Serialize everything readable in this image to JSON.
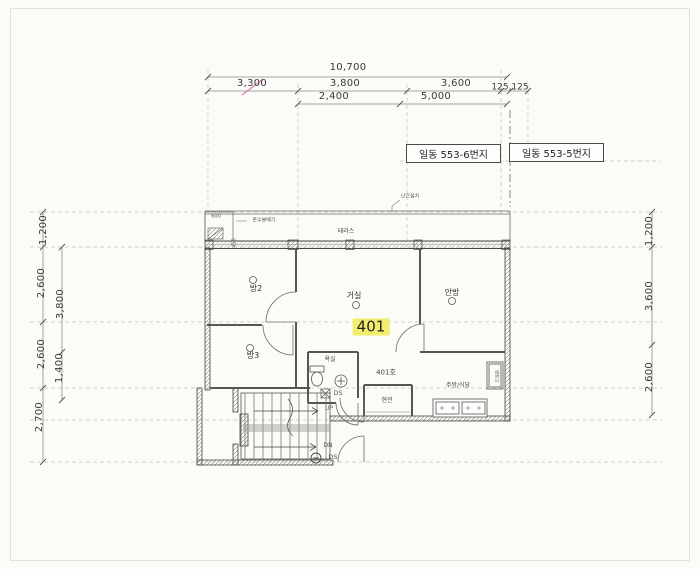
{
  "colors": {
    "highlight": "#f1ee6d",
    "paper": "#fbfbf8"
  },
  "addresses": {
    "left": "일동 553-6번지",
    "right": "일동 553-5번지"
  },
  "dims": {
    "overall": "10,700",
    "t1": "3,300",
    "t2": "3,800",
    "t3": "3,600",
    "t4": "125,125",
    "t5": "2,400",
    "t6": "5,000",
    "l1": "1,200",
    "l2": "2,600",
    "l3": "2,600",
    "l4": "2,700",
    "li1": "3,800",
    "li2": "1,400",
    "r1": "1,200",
    "r2": "3,600",
    "r3": "2,600"
  },
  "rooms": {
    "terrace": "테라스",
    "room2": "방2",
    "room3": "방3",
    "living": "거실",
    "master": "안방",
    "bath": "욕실",
    "entry": "현관",
    "kitchen": "주방/식당"
  },
  "labels": {
    "unit_no": "401호",
    "unit_highlight": "401",
    "railing": "난간설치",
    "up": "UP",
    "dn": "DN",
    "ds_top": "DS",
    "ds_bottom": "DS",
    "fridge": "냉장고",
    "d600": "600",
    "d450": "450",
    "manifold": "온수분배기"
  }
}
